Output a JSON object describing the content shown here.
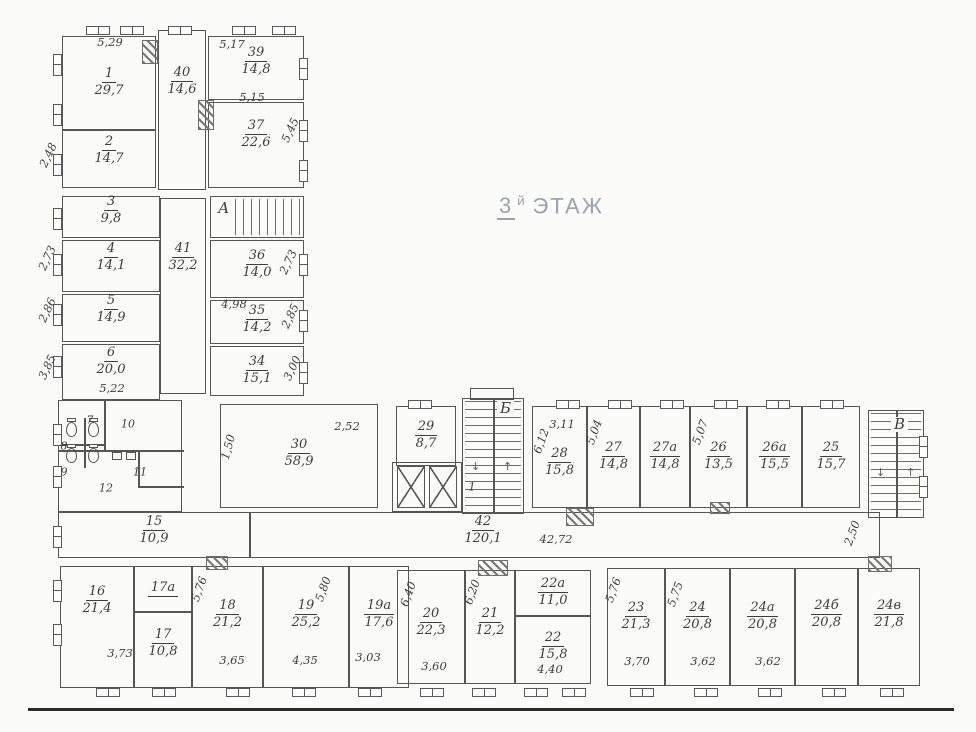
{
  "title": {
    "floor": "3",
    "sup": "й",
    "word": "ЭТАЖ"
  },
  "colors": {
    "line": "#565656",
    "text": "#3d3d3d",
    "title": "#9aa3ae"
  },
  "drawing": {
    "rooms": [
      {
        "id": "r1",
        "number": "1",
        "area": "29,7"
      },
      {
        "id": "r40",
        "number": "40",
        "area": "14,6"
      },
      {
        "id": "r39",
        "number": "39",
        "area": "14,8"
      },
      {
        "id": "r37",
        "number": "37",
        "area": "22,6"
      },
      {
        "id": "r2",
        "number": "2",
        "area": "14,7"
      },
      {
        "id": "r3",
        "number": "3",
        "area": "9,8"
      },
      {
        "id": "r4",
        "number": "4",
        "area": "14,1"
      },
      {
        "id": "r5",
        "number": "5",
        "area": "14,9"
      },
      {
        "id": "r6",
        "number": "6",
        "area": "20,0"
      },
      {
        "id": "r41",
        "number": "41",
        "area": "32,2"
      },
      {
        "id": "r36",
        "number": "36",
        "area": "14,0"
      },
      {
        "id": "r35",
        "number": "35",
        "area": "14,2"
      },
      {
        "id": "r34",
        "number": "34",
        "area": "15,1"
      },
      {
        "id": "r15",
        "number": "15",
        "area": "10,9"
      },
      {
        "id": "r30",
        "number": "30",
        "area": "58,9"
      },
      {
        "id": "r29",
        "number": "29",
        "area": "8,7"
      },
      {
        "id": "r42",
        "number": "42",
        "area": "120,1"
      },
      {
        "id": "r28",
        "number": "28",
        "area": "15,8"
      },
      {
        "id": "r27",
        "number": "27",
        "area": "14,8"
      },
      {
        "id": "r27a",
        "number": "27а",
        "area": "14,8"
      },
      {
        "id": "r26",
        "number": "26",
        "area": "13,5"
      },
      {
        "id": "r26a",
        "number": "26а",
        "area": "15,5"
      },
      {
        "id": "r25",
        "number": "25",
        "area": "15,7"
      },
      {
        "id": "r16",
        "number": "16",
        "area": "21,4"
      },
      {
        "id": "r17a",
        "number": "17а",
        "area": ""
      },
      {
        "id": "r17",
        "number": "17",
        "area": "10,8"
      },
      {
        "id": "r18",
        "number": "18",
        "area": "21,2"
      },
      {
        "id": "r19",
        "number": "19",
        "area": "25,2"
      },
      {
        "id": "r19a",
        "number": "19а",
        "area": "17,6"
      },
      {
        "id": "r20",
        "number": "20",
        "area": "22,3"
      },
      {
        "id": "r21",
        "number": "21",
        "area": "12,2"
      },
      {
        "id": "r22a",
        "number": "22а",
        "area": "11,0"
      },
      {
        "id": "r22",
        "number": "22",
        "area": "15,8"
      },
      {
        "id": "r23",
        "number": "23",
        "area": "21,3"
      },
      {
        "id": "r24",
        "number": "24",
        "area": "20,8"
      },
      {
        "id": "r24a",
        "number": "24а",
        "area": "20,8"
      },
      {
        "id": "r24b",
        "number": "24б",
        "area": "20,8"
      },
      {
        "id": "r24v",
        "number": "24в",
        "area": "21,8"
      }
    ],
    "dims": [
      {
        "id": "d529",
        "text": "5,29"
      },
      {
        "id": "d517",
        "text": "5,17"
      },
      {
        "id": "d515",
        "text": "5,15"
      },
      {
        "id": "d545",
        "text": "5,45"
      },
      {
        "id": "d248",
        "text": "2,48"
      },
      {
        "id": "d273l",
        "text": "2,73"
      },
      {
        "id": "d286",
        "text": "2,86"
      },
      {
        "id": "d385",
        "text": "3,85"
      },
      {
        "id": "d522",
        "text": "5,22"
      },
      {
        "id": "d273r",
        "text": "2,73"
      },
      {
        "id": "d498",
        "text": "4,98"
      },
      {
        "id": "d285",
        "text": "2,85"
      },
      {
        "id": "d300",
        "text": "3,00"
      },
      {
        "id": "d252",
        "text": "2,52"
      },
      {
        "id": "d150",
        "text": "1,50"
      },
      {
        "id": "d311",
        "text": "3,11"
      },
      {
        "id": "d612",
        "text": "6,12"
      },
      {
        "id": "d504",
        "text": "5,04"
      },
      {
        "id": "d507",
        "text": "5,07"
      },
      {
        "id": "d4272",
        "text": "42,72"
      },
      {
        "id": "d250",
        "text": "2,50"
      },
      {
        "id": "d576a",
        "text": "5,76"
      },
      {
        "id": "d580",
        "text": "5,80"
      },
      {
        "id": "d373",
        "text": "3,73"
      },
      {
        "id": "d365",
        "text": "3,65"
      },
      {
        "id": "d435",
        "text": "4,35"
      },
      {
        "id": "d303",
        "text": "3,03"
      },
      {
        "id": "d640",
        "text": "6,40"
      },
      {
        "id": "d620",
        "text": "6,20"
      },
      {
        "id": "d360",
        "text": "3,60"
      },
      {
        "id": "d440",
        "text": "4,40"
      },
      {
        "id": "d576b",
        "text": "5,76"
      },
      {
        "id": "d575",
        "text": "5,75"
      },
      {
        "id": "d370",
        "text": "3,70"
      },
      {
        "id": "d362a",
        "text": "3,62"
      },
      {
        "id": "d362b",
        "text": "3,62"
      }
    ],
    "small_labels": [
      {
        "id": "s7",
        "text": "7"
      },
      {
        "id": "s8",
        "text": "8"
      },
      {
        "id": "s9",
        "text": "9"
      },
      {
        "id": "s10",
        "text": "10"
      },
      {
        "id": "s11",
        "text": "11"
      },
      {
        "id": "s12",
        "text": "12"
      },
      {
        "id": "s1",
        "text": "1"
      }
    ],
    "stairs": [
      {
        "id": "sA",
        "label": "А"
      },
      {
        "id": "sB",
        "label": "Б"
      },
      {
        "id": "sV",
        "label": "В"
      }
    ]
  }
}
